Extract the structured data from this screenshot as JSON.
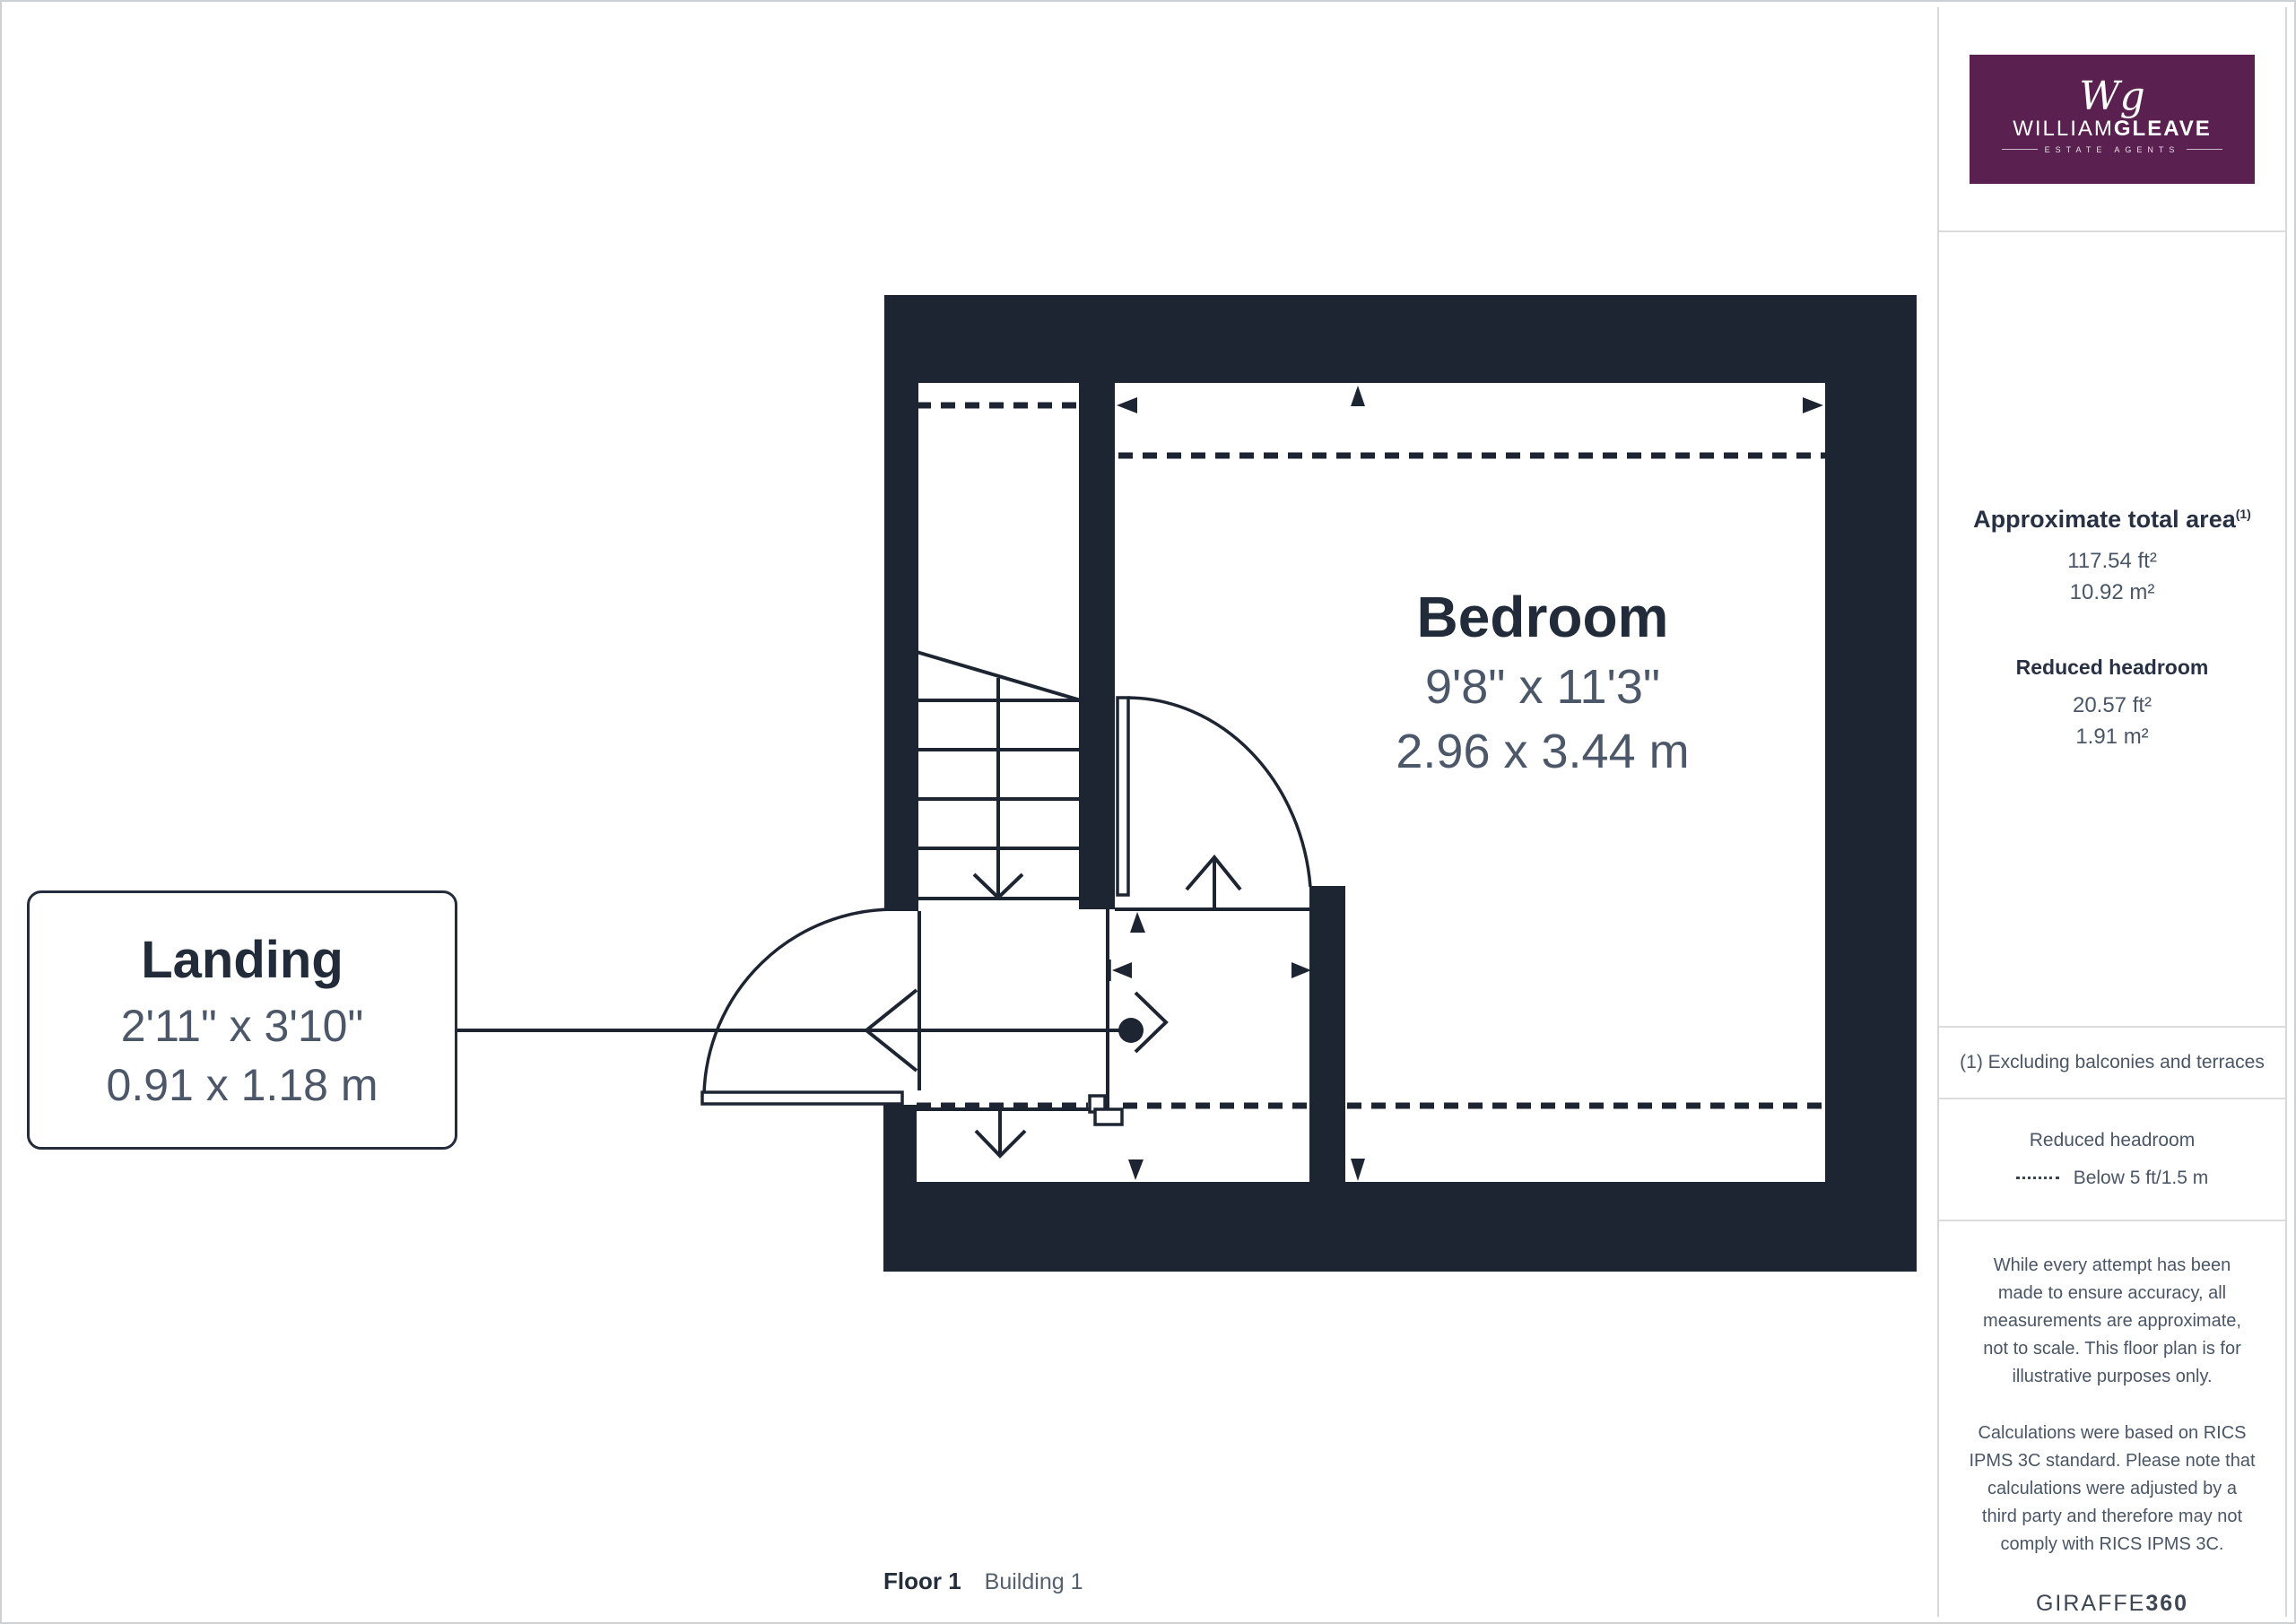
{
  "plan": {
    "rooms": {
      "bedroom": {
        "name": "Bedroom",
        "imperial": "9'8\" x 11'3\"",
        "metric": "2.96 x 3.44 m"
      },
      "landing": {
        "name": "Landing",
        "imperial": "2'11\" x 3'10\"",
        "metric": "0.91 x 1.18 m"
      }
    },
    "floor_label": {
      "floor": "Floor 1",
      "building": "Building 1"
    },
    "colors": {
      "wall": "#1e2532",
      "title_text": "#222b39",
      "dim_text": "#4c5869"
    }
  },
  "sidebar": {
    "logo": {
      "monogram": "Wg",
      "name_thin": "WILLIAM",
      "name_bold": "GLEAVE",
      "subtitle": "ESTATE AGENTS",
      "background": "#5a2150"
    },
    "area": {
      "heading": "Approximate total area",
      "heading_superscript": "(1)",
      "value_ft": "117.54 ft²",
      "value_m": "10.92 m²"
    },
    "reduced_headroom": {
      "heading": "Reduced headroom",
      "value_ft": "20.57 ft²",
      "value_m": "1.91 m²"
    },
    "note": "(1) Excluding balconies and terraces",
    "legend": {
      "title": "Reduced headroom",
      "dash_label": "Below 5 ft/1.5 m"
    },
    "disclaimer_1": "While every attempt has been made to ensure accuracy, all measurements are approximate, not to scale. This floor plan is for illustrative purposes only.",
    "disclaimer_2": "Calculations were based on RICS IPMS 3C standard. Please note that calculations were adjusted by a third party and therefore may not comply with RICS IPMS 3C.",
    "brand": {
      "name": "GIRAFFE",
      "suffix": "360"
    }
  }
}
